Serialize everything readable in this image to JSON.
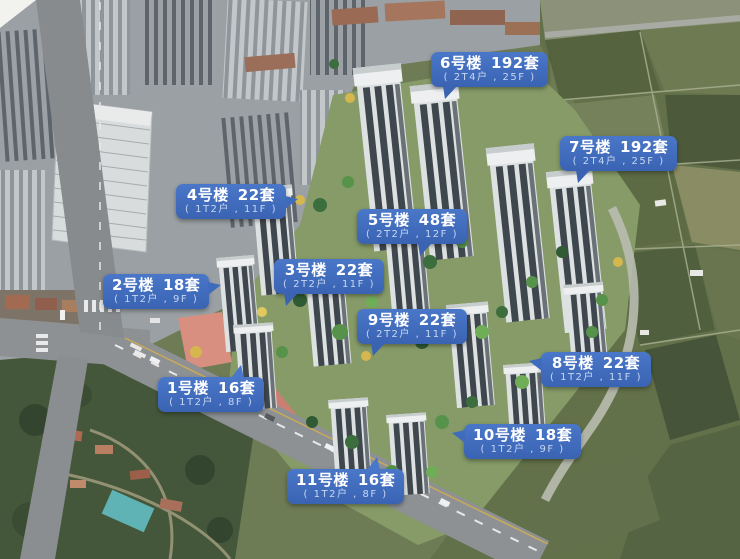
{
  "label_style": {
    "background": "#3f6bbd",
    "text_color": "#ffffff",
    "subtext_color": "#c7d7f3"
  },
  "buildings": [
    {
      "id": "1",
      "name": "1号楼",
      "units": "16套",
      "spec": "( 1T2户 , 8F )"
    },
    {
      "id": "2",
      "name": "2号楼",
      "units": "18套",
      "spec": "( 1T2户 , 9F )"
    },
    {
      "id": "3",
      "name": "3号楼",
      "units": "22套",
      "spec": "( 2T2户 , 11F )"
    },
    {
      "id": "4",
      "name": "4号楼",
      "units": "22套",
      "spec": "( 1T2户 , 11F )"
    },
    {
      "id": "5",
      "name": "5号楼",
      "units": "48套",
      "spec": "( 2T2户 , 12F )"
    },
    {
      "id": "6",
      "name": "6号楼",
      "units": "192套",
      "spec": "( 2T4户 , 25F )"
    },
    {
      "id": "7",
      "name": "7号楼",
      "units": "192套",
      "spec": "( 2T4户 , 25F )"
    },
    {
      "id": "8",
      "name": "8号楼",
      "units": "22套",
      "spec": "( 1T2户 , 11F )"
    },
    {
      "id": "9",
      "name": "9号楼",
      "units": "22套",
      "spec": "( 2T2户 , 11F )"
    },
    {
      "id": "10",
      "name": "10号楼",
      "units": "18套",
      "spec": "( 1T2户 , 9F )"
    },
    {
      "id": "11",
      "name": "11号楼",
      "units": "16套",
      "spec": "( 1T2户 , 8F )"
    }
  ]
}
